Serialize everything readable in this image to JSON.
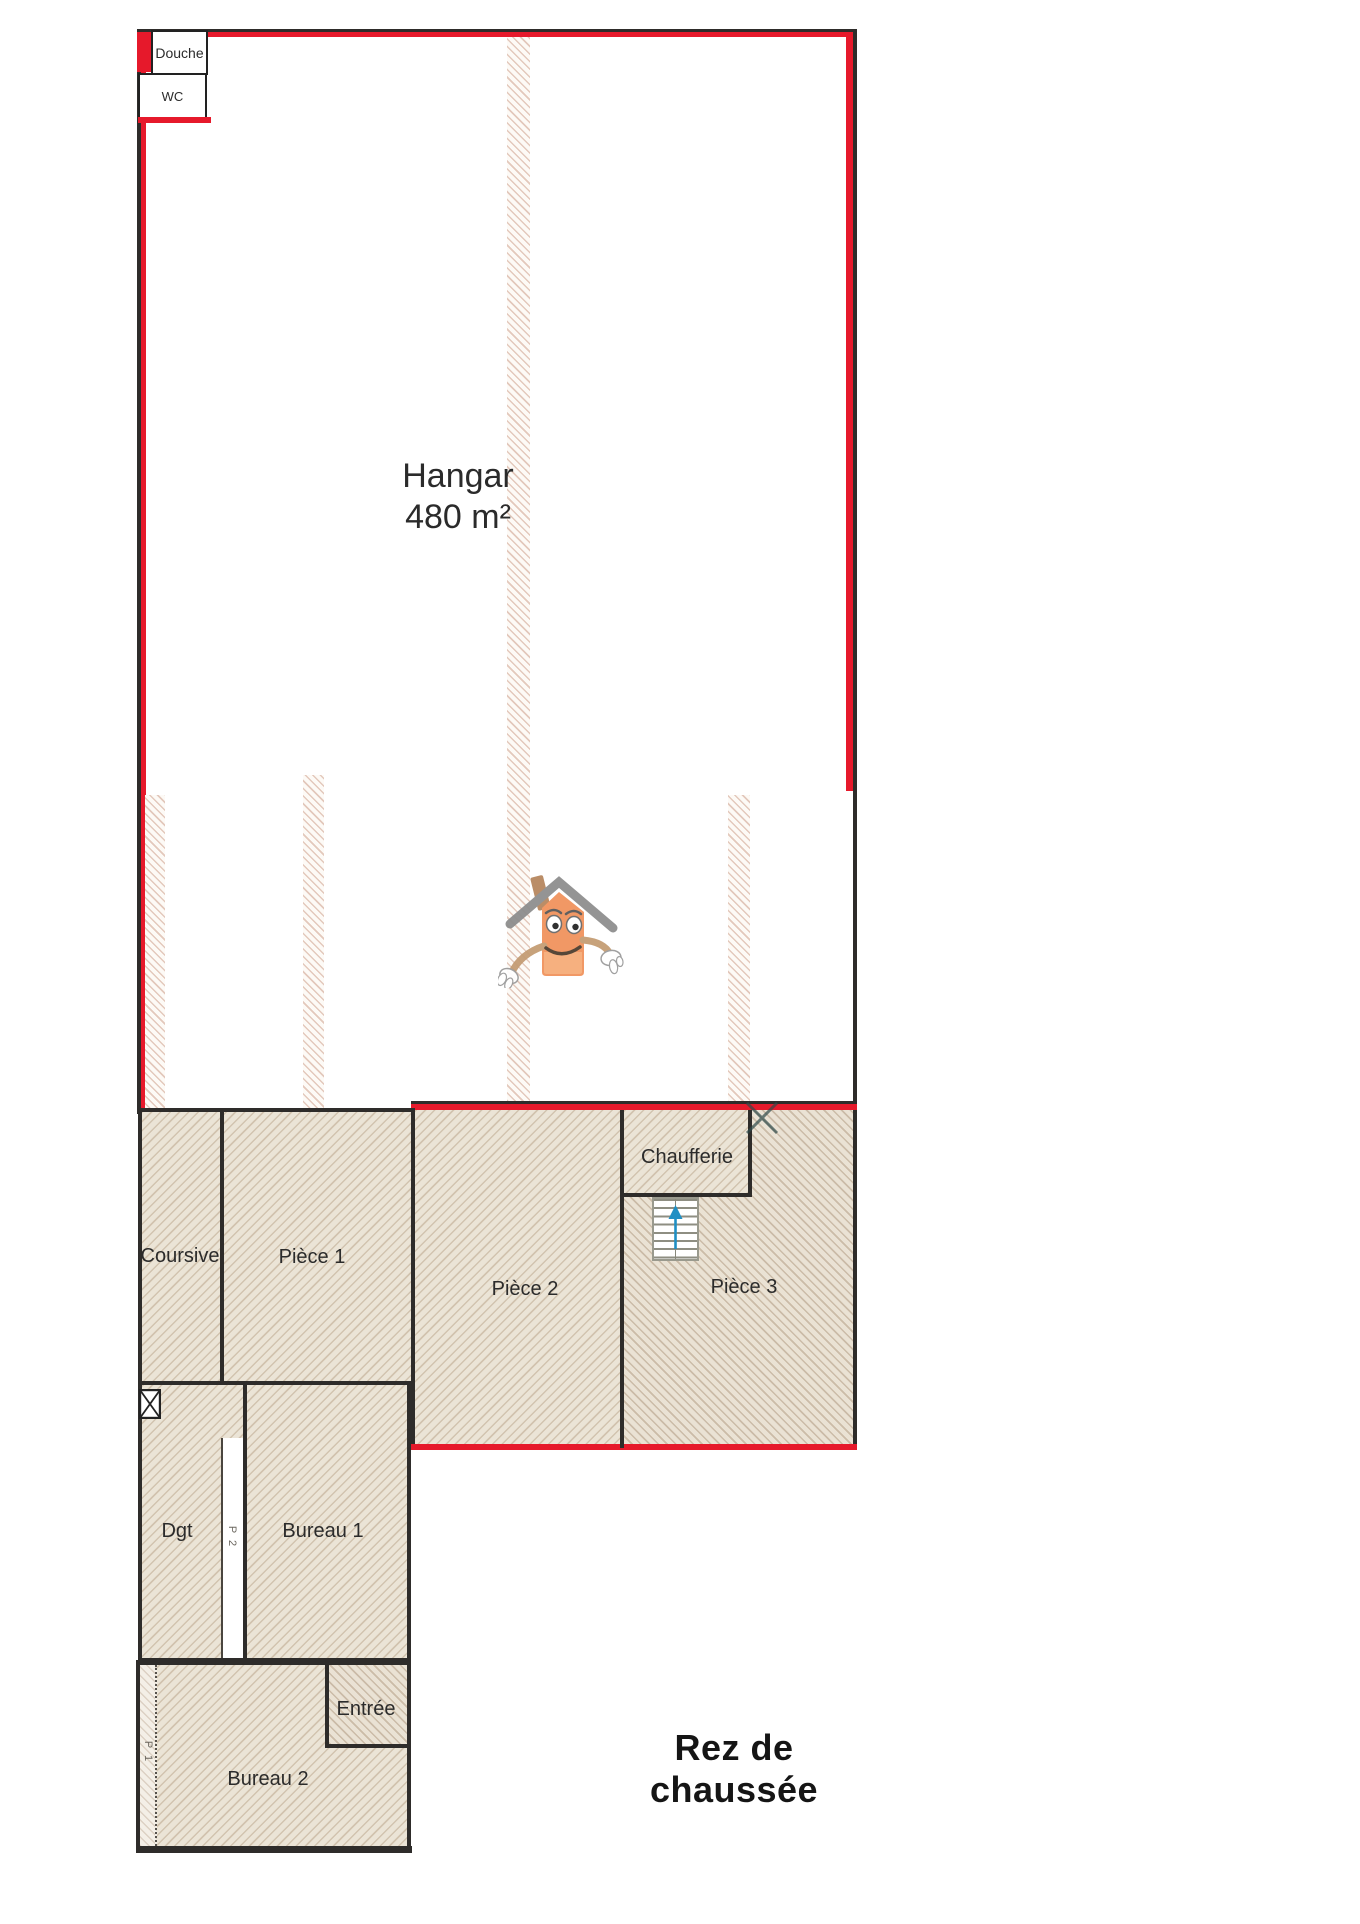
{
  "title": "Rez de chaussée",
  "hangar": {
    "name": "Hangar",
    "area": "480 m²"
  },
  "rooms": {
    "douche": "Douche",
    "wc": "WC",
    "coursive": "Coursive",
    "piece1": "Pièce 1",
    "piece2": "Pièce 2",
    "piece3": "Pièce 3",
    "chaufferie": "Chaufferie",
    "dgt": "Dgt",
    "bureau1": "Bureau 1",
    "bureau2": "Bureau 2",
    "entree": "Entrée"
  },
  "door_labels": {
    "p1": "P 1",
    "p2": "P 2"
  },
  "icons": {
    "logo": "house-mascot-logo",
    "window": "window-x-symbol",
    "stairs": "staircase-with-up-arrow",
    "door_mark": "door-swing-cross"
  },
  "colors": {
    "wall_red": "#e6192b",
    "wall_dark": "#2e2c2a",
    "hatch_fill": "#ebe4d6",
    "stair_arrow_blue": "#1f8fc4",
    "logo_orange": "#f0915a"
  }
}
